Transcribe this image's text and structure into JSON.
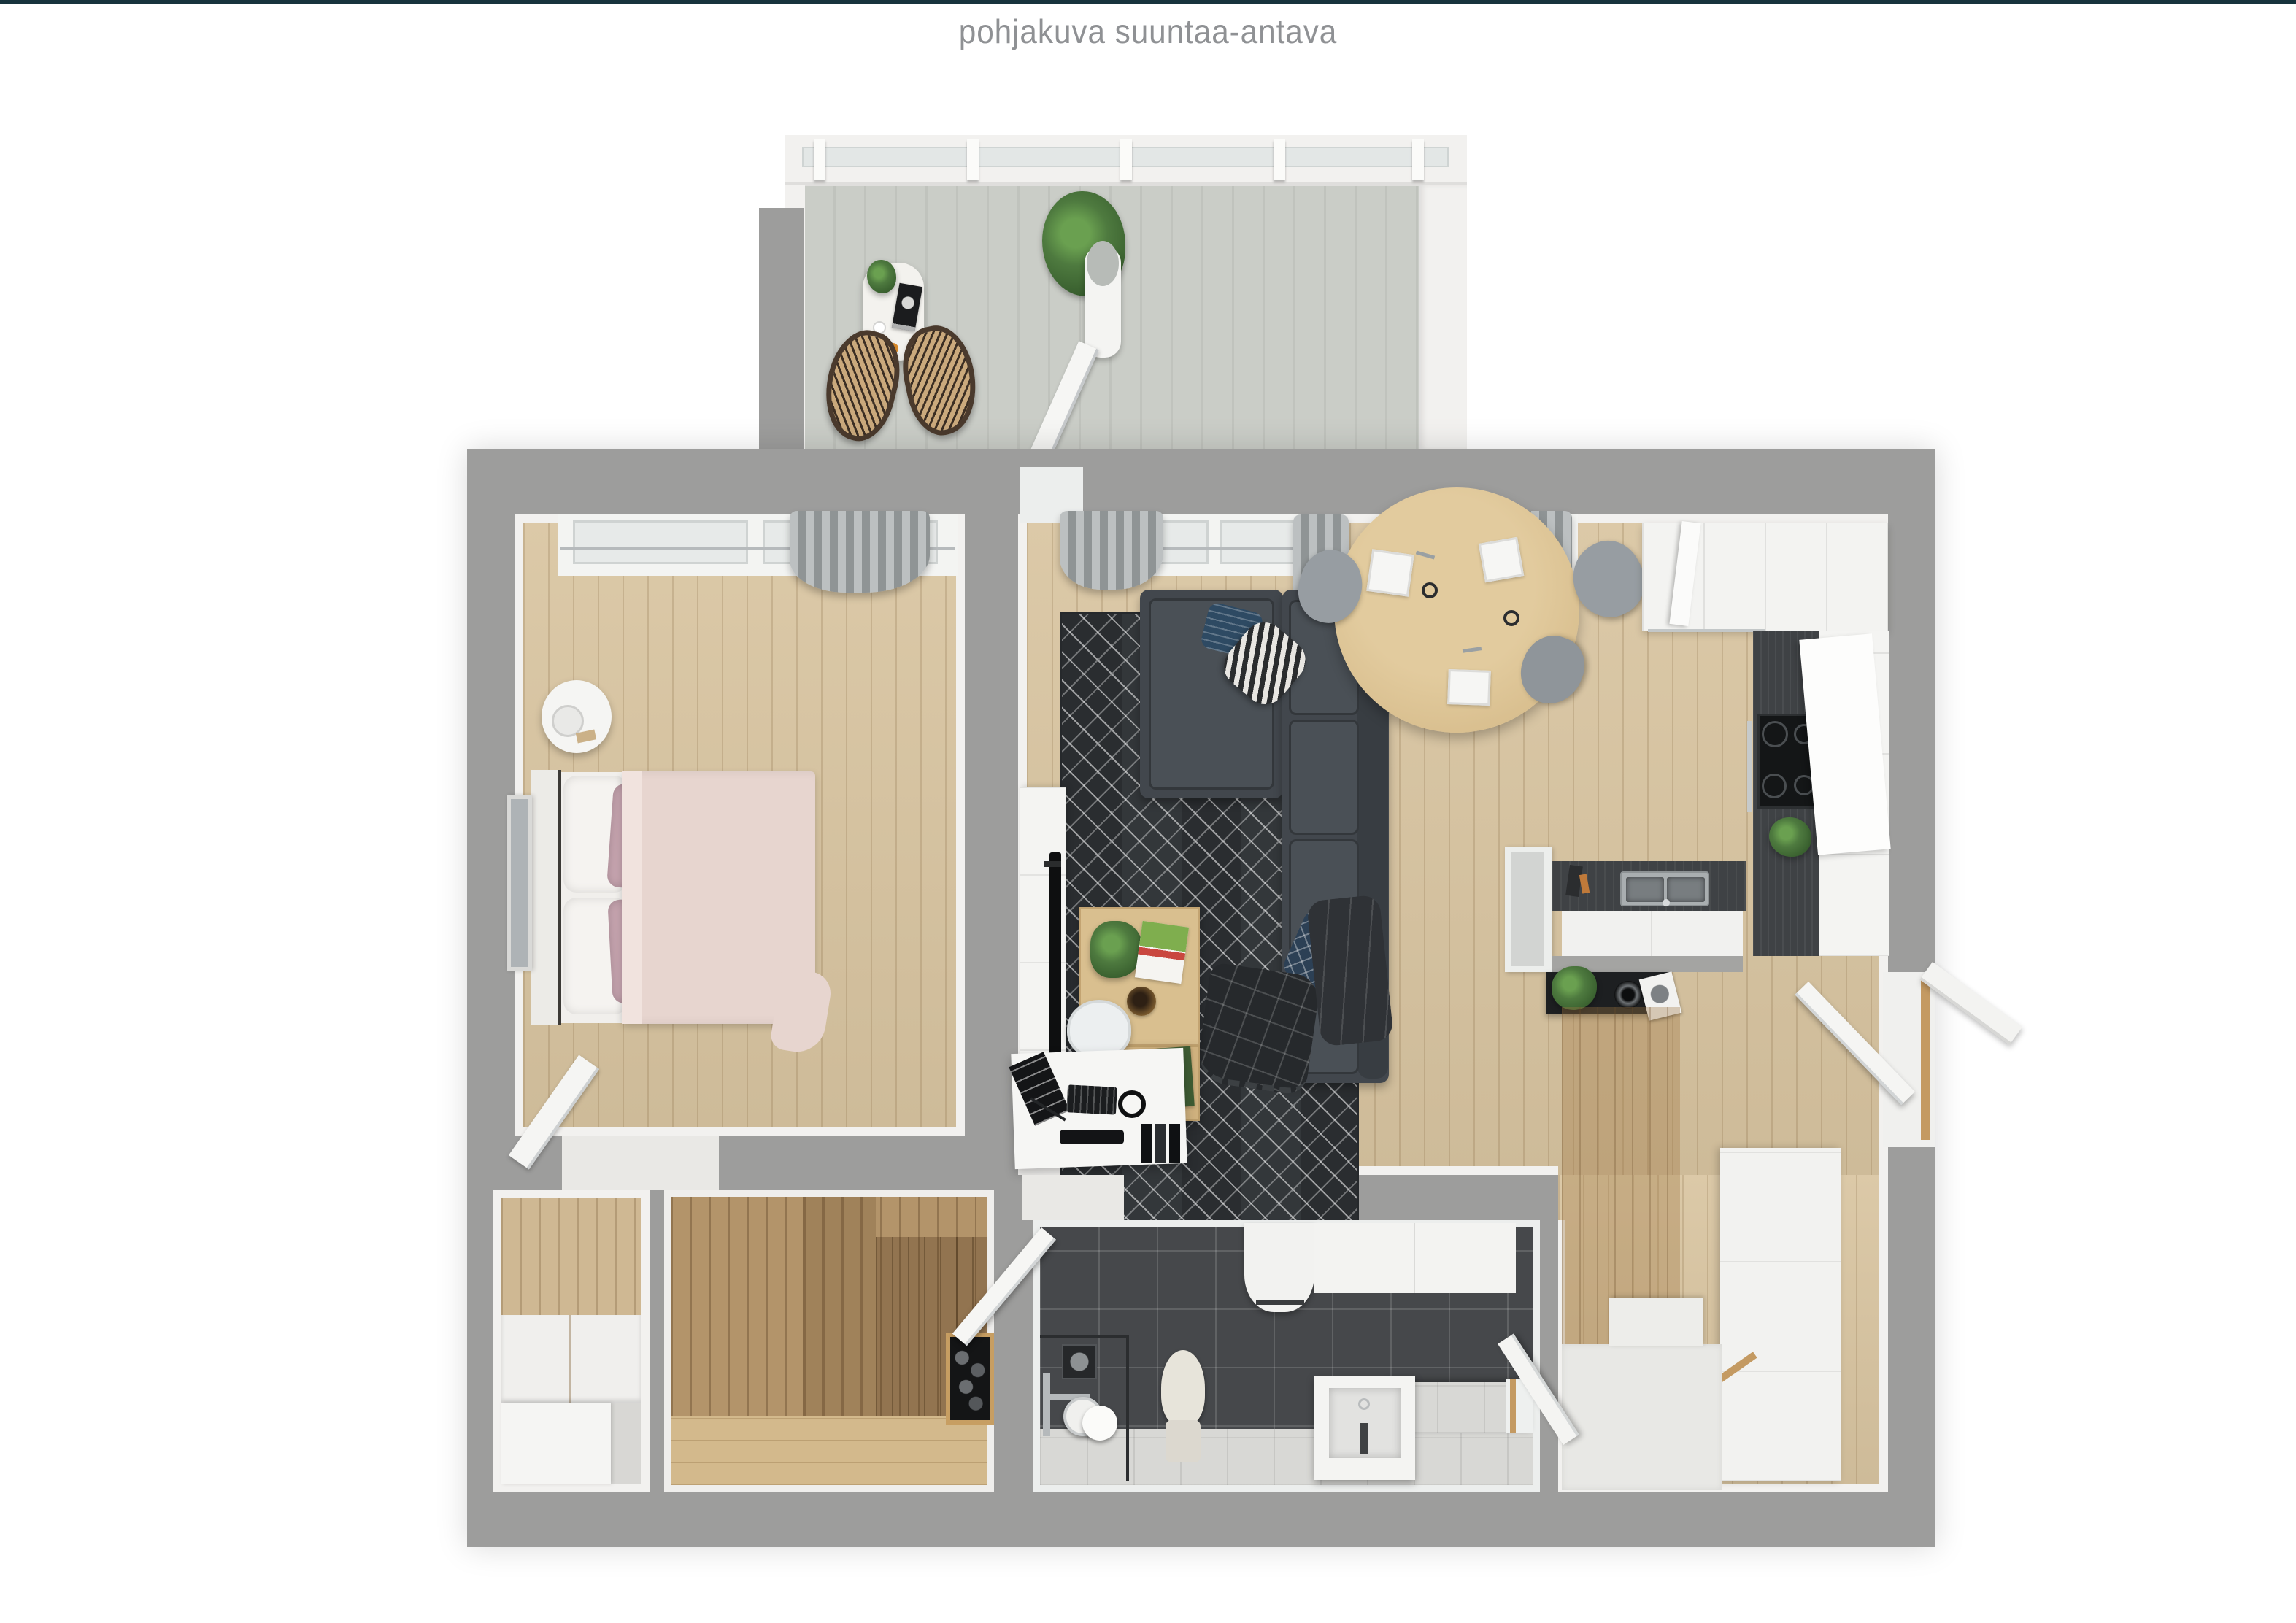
{
  "page": {
    "title": "pohjakuva suuntaa-antava"
  },
  "theme": {
    "accent-line": "#17333d",
    "title-color": "#8f9194",
    "wall-gray": "#9d9d9c",
    "wall-face": "#f2f1ef",
    "wood-floor": "#d9c5a1",
    "sauna-wood": "#b3946a",
    "sauna-floor": "#d3b98c",
    "dark-tile": "#46484b",
    "light-tile": "#d8d8d5",
    "balcony-floor": "#cacdc7",
    "rug-dark": "#33373a",
    "sofa-gray": "#42474d",
    "sofa-cushion": "#4a5056",
    "bed-blanket": "#e7d5cf",
    "pillow-pink": "#c5a3ae",
    "table-wood": "#d9bf8f",
    "counter-dark": "#3f4245",
    "sideboard-black": "#1d1f21",
    "plant-green": "#4e7a3f"
  }
}
